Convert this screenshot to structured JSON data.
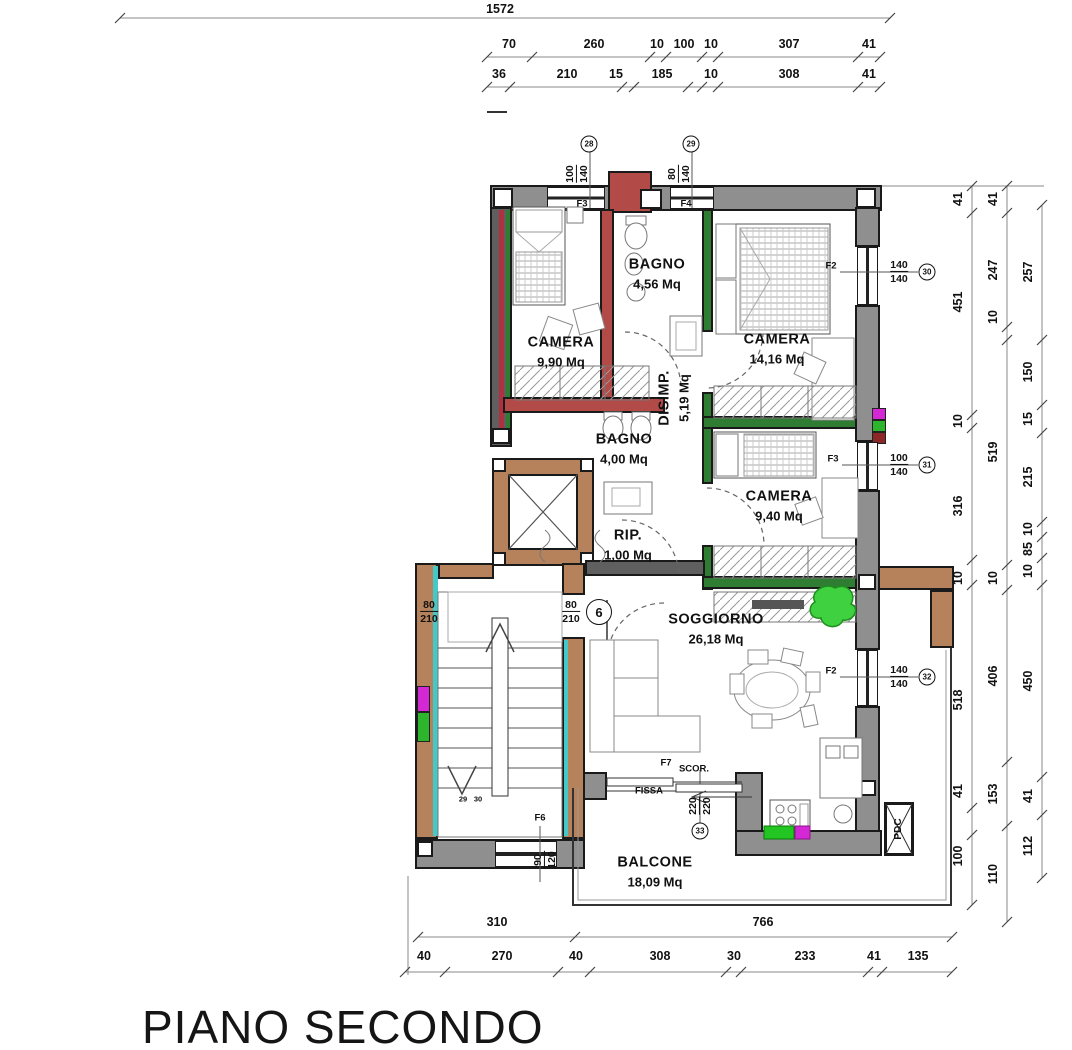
{
  "title": "PIANO SECONDO",
  "dims": {
    "top_total": "1572",
    "top_row1": [
      "70",
      "260",
      "10",
      "100",
      "10",
      "307",
      "41"
    ],
    "top_row2": [
      "36",
      "210",
      "15",
      "185",
      "10",
      "308",
      "41"
    ],
    "right_col1": [
      "41",
      "451",
      "10",
      "316",
      "10",
      "518",
      "41",
      "100"
    ],
    "right_col2": [
      "41",
      "247",
      "10",
      "519",
      "10",
      "406",
      "153",
      "110"
    ],
    "right_col3": [
      "257",
      "150",
      "15",
      "215",
      "10",
      "85",
      "10",
      "450",
      "41",
      "112"
    ],
    "bottom_row1": [
      "310",
      "766"
    ],
    "bottom_row2": [
      "40",
      "270",
      "40",
      "308",
      "30",
      "233",
      "41",
      "135"
    ]
  },
  "rooms": {
    "camera1": {
      "name": "CAMERA",
      "area": "9,90 Mq"
    },
    "bagno1": {
      "name": "BAGNO",
      "area": "4,56 Mq"
    },
    "camera2": {
      "name": "CAMERA",
      "area": "14,16 Mq"
    },
    "disimpegno": {
      "name": "DISIMP.",
      "area": "5,19 Mq"
    },
    "bagno2": {
      "name": "BAGNO",
      "area": "4,00 Mq"
    },
    "camera3": {
      "name": "CAMERA",
      "area": "9,40 Mq"
    },
    "ripostiglio": {
      "name": "RIP.",
      "area": "1,00 Mq"
    },
    "soggiorno": {
      "name": "SOGGIORNO",
      "area": "26,18 Mq"
    },
    "balcone": {
      "name": "BALCONE",
      "area": "18,09 Mq"
    }
  },
  "openings": {
    "f3_top": {
      "label": "F3",
      "w": "100",
      "h": "140",
      "num": "28"
    },
    "f4_top": {
      "label": "F4",
      "w": "80",
      "h": "140",
      "num": "29"
    },
    "f2_up": {
      "label": "F2",
      "w": "140",
      "h": "140",
      "num": "30"
    },
    "f3_right": {
      "label": "F3",
      "w": "100",
      "h": "140",
      "num": "31"
    },
    "f2_low": {
      "label": "F2",
      "w": "140",
      "h": "140",
      "num": "32"
    },
    "f7": {
      "label": "F7",
      "type": "SCOR.",
      "fixed": "FISSA",
      "w": "220",
      "h": "220",
      "num": "33"
    },
    "f6": {
      "label": "F6",
      "w": "90",
      "h": "120"
    },
    "entry_door": {
      "w": "80",
      "h": "210",
      "num": "6"
    },
    "stair_door": {
      "w": "80",
      "h": "210"
    }
  },
  "equipment": {
    "pdc": "PDC"
  },
  "stair_marks": [
    "29",
    "30"
  ],
  "colors": {
    "wall_gray": "#8f8f8f",
    "wall_brown": "#b5825c",
    "wall_red": "#b24a48",
    "wall_green": "#2f7d32",
    "stair_cyan": "#45c8c8",
    "plant_green": "#3fd13f",
    "patch_magenta": "#d428d4",
    "patch_green": "#2db52d"
  }
}
